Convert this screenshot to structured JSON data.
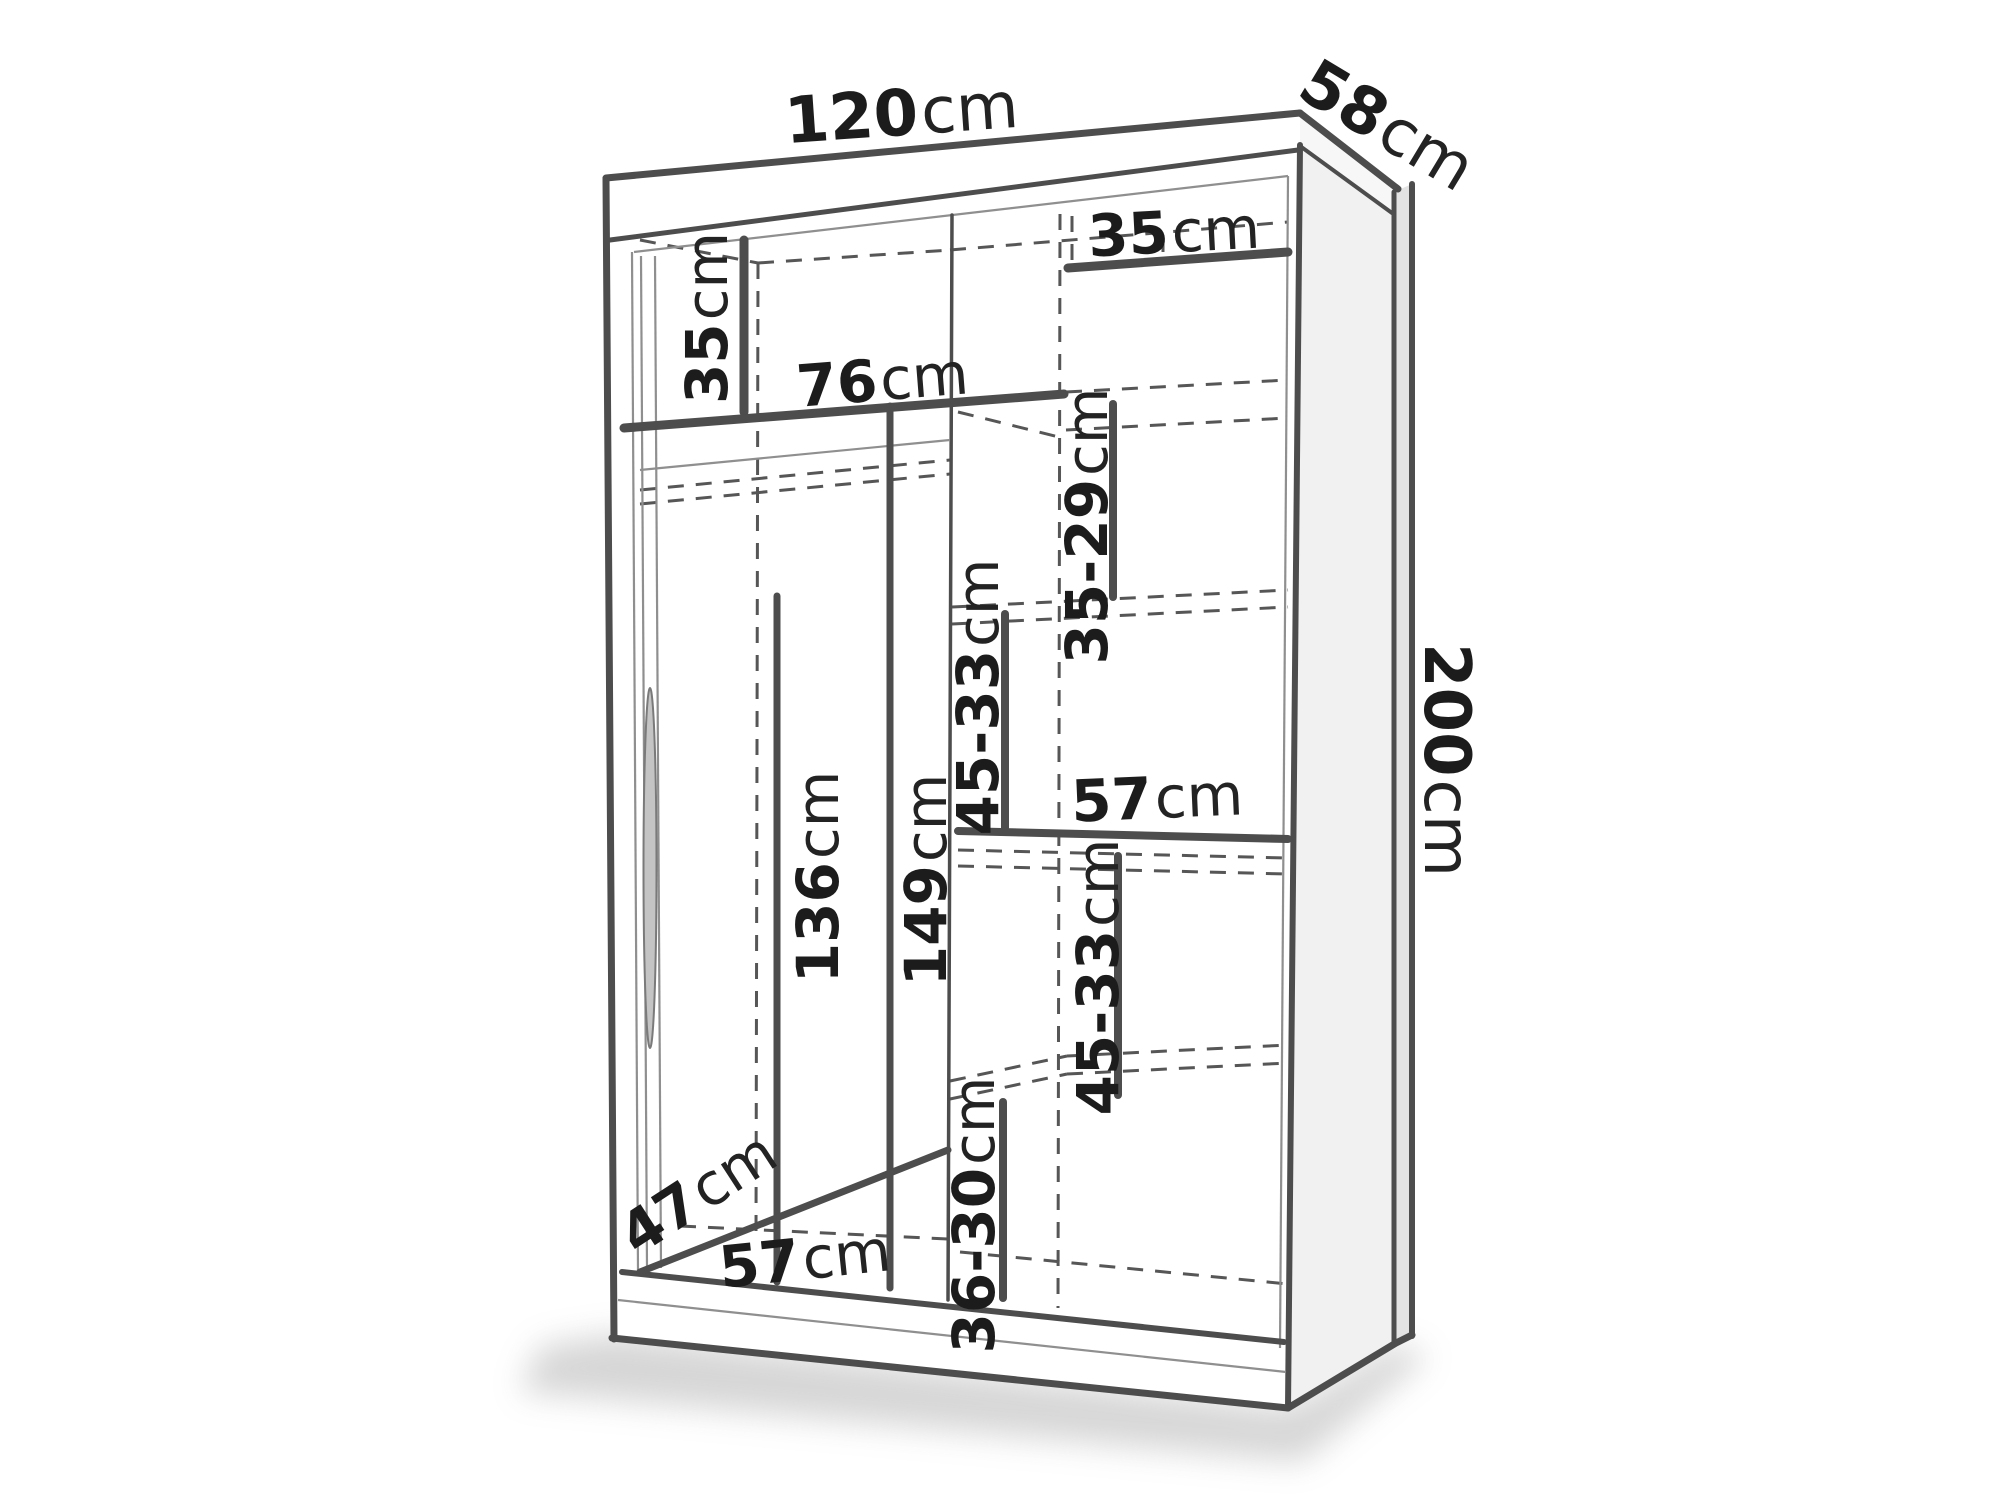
{
  "diagram": {
    "type": "furniture-dimension-diagram",
    "subject": "sliding-door wardrobe with internal shelving",
    "colors": {
      "background": "#ffffff",
      "line": "#4d4d4d",
      "dashed_line": "#565656",
      "label_text": "#1c1c1c",
      "side_panel": "#f1f1f1",
      "back_edge_strip": "#e3e3e3"
    },
    "labels": {
      "width": {
        "value": "120",
        "unit": "cm"
      },
      "depth": {
        "value": "58",
        "unit": "cm"
      },
      "height": {
        "value": "200",
        "unit": "cm"
      },
      "top_left_cubby": {
        "value": "35",
        "unit": "cm"
      },
      "top_right_shelf": {
        "value": "35",
        "unit": "cm"
      },
      "left_shelf_width": {
        "value": "76",
        "unit": "cm"
      },
      "right_comp_1": {
        "value": "35-29",
        "unit": "cm"
      },
      "right_comp_2": {
        "value": "45-33",
        "unit": "cm"
      },
      "right_shelf_width": {
        "value": "57",
        "unit": "cm"
      },
      "left_height_1": {
        "value": "136",
        "unit": "cm"
      },
      "left_height_2": {
        "value": "149",
        "unit": "cm"
      },
      "right_comp_3": {
        "value": "45-33",
        "unit": "cm"
      },
      "right_comp_4": {
        "value": "36-30",
        "unit": "cm"
      },
      "floor_depth": {
        "value": "47",
        "unit": "cm"
      },
      "floor_width": {
        "value": "57",
        "unit": "cm"
      }
    }
  }
}
